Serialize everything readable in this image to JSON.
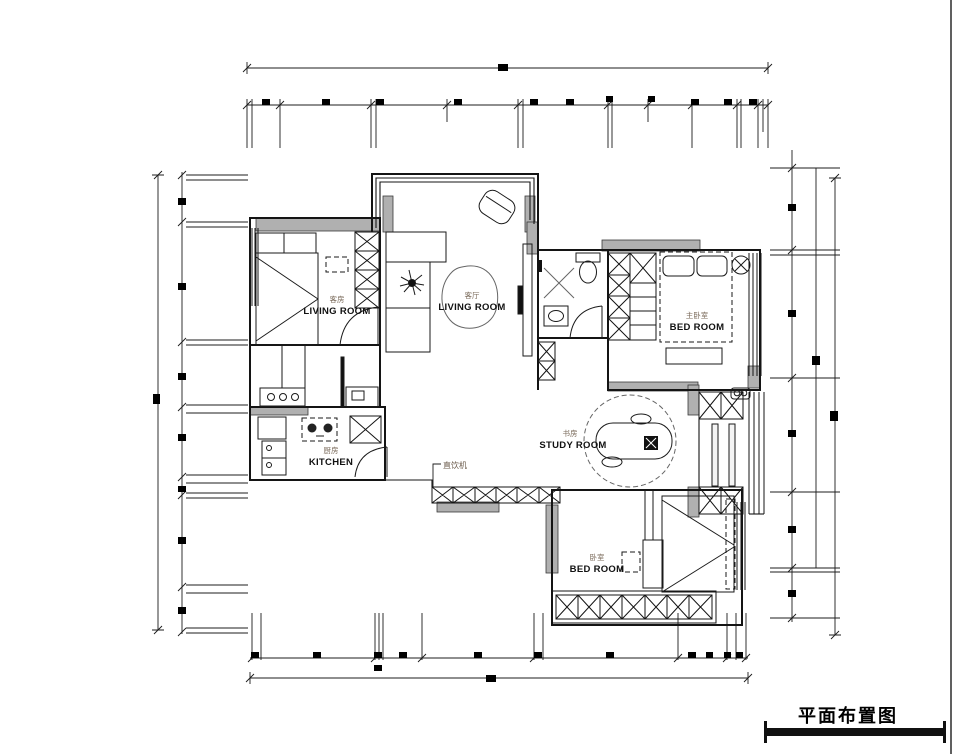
{
  "drawing": {
    "title": "平面布置图",
    "rooms": {
      "guest_room": {
        "label_cn": "客房",
        "label_en": "LIVING ROOM"
      },
      "living_room": {
        "label_cn": "客厅",
        "label_en": "LIVING ROOM"
      },
      "master_bedroom": {
        "label_cn": "主卧室",
        "label_en": "BED ROOM"
      },
      "study_room": {
        "label_cn": "书房",
        "label_en": "STUDY ROOM"
      },
      "kitchen": {
        "label_cn": "厨房",
        "label_en": "KITCHEN"
      },
      "bedroom": {
        "label_cn": "卧室",
        "label_en": "BED ROOM"
      }
    },
    "annotations": {
      "water_dispenser": "直饮机"
    },
    "colors": {
      "background": "#ffffff",
      "line": "#141414",
      "wall_fill": "#b0b0b0"
    }
  }
}
